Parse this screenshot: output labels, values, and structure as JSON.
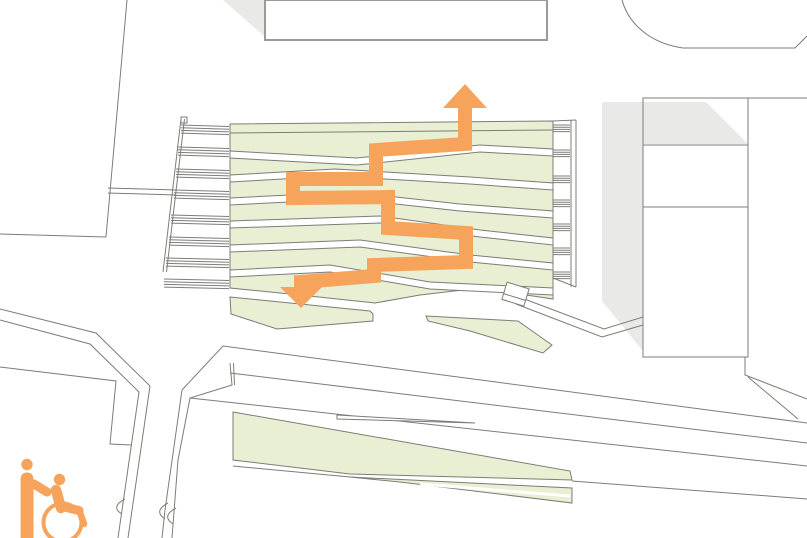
{
  "meta": {
    "kind": "architectural-site-plan",
    "description": "Accessibility route diagram over terraced landscape plan"
  },
  "colors": {
    "orange": "#F6A45C",
    "green": "#E9EFD2",
    "shadow": "#E9E9E7",
    "line": "#7C7C78",
    "buildingStroke": "#9A9A96",
    "white": "#ffffff"
  },
  "icons": {
    "legend": "wheelchair-with-attendant-icon",
    "route_up": "route-arrow-up-icon",
    "route_down": "route-arrow-down-icon"
  },
  "plan": {
    "width": 807,
    "height": 538,
    "shapes": [
      {
        "n": "building-right-fill",
        "t": "rect",
        "x": 643,
        "y": 98,
        "w": 105,
        "h": 259,
        "fill": "$white",
        "stroke": "none"
      },
      {
        "n": "shadow-top-left",
        "t": "polygon",
        "p": "223,0 265,0 265,37",
        "fill": "$shadow",
        "stroke": "none"
      },
      {
        "n": "shadow-right-building",
        "t": "polygon",
        "p": "602,102 706,102 748,144 643,144 643,351 602,301",
        "fill": "$shadow",
        "stroke": "none"
      },
      {
        "n": "building-top-center",
        "t": "rect",
        "x": 265,
        "y": 0,
        "w": 282,
        "h": 40,
        "fill": "$white",
        "stroke": "$buildingStroke",
        "sw": 2
      },
      {
        "n": "building-top-right-outline",
        "t": "path",
        "d": "M622,0 C628,22 648,43 683,48 L795,48 L807,36"
      },
      {
        "n": "building-right-outline",
        "t": "rect",
        "x": 643,
        "y": 98,
        "w": 105,
        "h": 259
      },
      {
        "n": "building-right-floor-line-1",
        "t": "line",
        "x1": 643,
        "y1": 145,
        "x2": 748,
        "y2": 145
      },
      {
        "n": "building-right-floor-line-2",
        "t": "line",
        "x1": 643,
        "y1": 207,
        "x2": 748,
        "y2": 207
      },
      {
        "n": "building-right-top-edge-ext",
        "t": "line",
        "x1": 748,
        "y1": 98,
        "x2": 807,
        "y2": 98
      },
      {
        "n": "plaza-boundary-diagonal",
        "t": "line",
        "x1": 127,
        "y1": 0,
        "x2": 106,
        "y2": 237
      },
      {
        "n": "plaza-boundary-bottom",
        "t": "line",
        "x1": 0,
        "y1": 234,
        "x2": 106,
        "y2": 237
      },
      {
        "n": "walkway-line-1",
        "t": "line",
        "x1": 108,
        "y1": 188,
        "x2": 176,
        "y2": 190
      },
      {
        "n": "walkway-line-2",
        "t": "line",
        "x1": 108,
        "y1": 193,
        "x2": 176,
        "y2": 195
      },
      {
        "n": "stairs-left-wall-outer",
        "t": "line",
        "x1": 181,
        "y1": 119,
        "x2": 163,
        "y2": 272
      },
      {
        "n": "stairs-left-wall-inner",
        "t": "line",
        "x1": 184.5,
        "y1": 119,
        "x2": 166.5,
        "y2": 272
      },
      {
        "n": "stairs-left-wall-cap",
        "t": "rect",
        "x": 181,
        "y": 117,
        "w": 6,
        "h": 6
      },
      {
        "n": "stairs-left-steps-1",
        "t": "hatch",
        "y": 125,
        "x1": 181,
        "x2": 229,
        "c": 4,
        "gap": 2.7,
        "dy": 1.5
      },
      {
        "n": "stairs-left-steps-2",
        "t": "hatch",
        "y": 147,
        "x1": 178,
        "x2": 229,
        "c": 4,
        "gap": 2.7,
        "dy": 1.5
      },
      {
        "n": "stairs-left-steps-3",
        "t": "hatch",
        "y": 169,
        "x1": 176,
        "x2": 229,
        "c": 4,
        "gap": 2.7,
        "dy": 1.5
      },
      {
        "n": "stairs-left-steps-4",
        "t": "hatch",
        "y": 190,
        "x1": 174,
        "x2": 229,
        "c": 4,
        "gap": 2.7,
        "dy": 1.5
      },
      {
        "n": "stairs-left-steps-5",
        "t": "hatch",
        "y": 215,
        "x1": 171,
        "x2": 229,
        "c": 4,
        "gap": 2.7,
        "dy": 1.5
      },
      {
        "n": "stairs-left-steps-6",
        "t": "hatch",
        "y": 237,
        "x1": 169,
        "x2": 229,
        "c": 4,
        "gap": 2.7,
        "dy": 1.5
      },
      {
        "n": "stairs-left-steps-7",
        "t": "hatch",
        "y": 258,
        "x1": 166,
        "x2": 229,
        "c": 4,
        "gap": 2.7,
        "dy": 1.5
      },
      {
        "n": "stairs-left-steps-8",
        "t": "hatch",
        "y": 279,
        "x1": 164,
        "x2": 229,
        "c": 4,
        "gap": 2.7,
        "dy": 1.5
      },
      {
        "n": "stairs-right-edge-1",
        "t": "line",
        "x1": 571,
        "y1": 120,
        "x2": 571,
        "y2": 287
      },
      {
        "n": "stairs-right-edge-2",
        "t": "line",
        "x1": 576,
        "y1": 120,
        "x2": 576,
        "y2": 287
      },
      {
        "n": "stairs-right-cap",
        "t": "line",
        "x1": 553,
        "y1": 121,
        "x2": 576,
        "y2": 120
      },
      {
        "n": "stairs-right-bottom",
        "t": "line",
        "x1": 553,
        "y1": 278,
        "x2": 576,
        "y2": 287
      },
      {
        "n": "stairs-right-steps-1",
        "t": "hatch",
        "y": 125,
        "x1": 553,
        "x2": 570,
        "c": 4,
        "gap": 2.2,
        "dy": 0
      },
      {
        "n": "stairs-right-steps-2",
        "t": "hatch",
        "y": 150,
        "x1": 553,
        "x2": 570,
        "c": 4,
        "gap": 2.2,
        "dy": 0
      },
      {
        "n": "stairs-right-steps-3",
        "t": "hatch",
        "y": 176,
        "x1": 553,
        "x2": 570,
        "c": 4,
        "gap": 2.2,
        "dy": 0
      },
      {
        "n": "stairs-right-steps-4",
        "t": "hatch",
        "y": 200,
        "x1": 553,
        "x2": 570,
        "c": 4,
        "gap": 2.2,
        "dy": 0
      },
      {
        "n": "stairs-right-steps-5",
        "t": "hatch",
        "y": 224,
        "x1": 553,
        "x2": 570,
        "c": 4,
        "gap": 2.2,
        "dy": 0
      },
      {
        "n": "stairs-right-steps-6",
        "t": "hatch",
        "y": 248,
        "x1": 553,
        "x2": 570,
        "c": 4,
        "gap": 2.2,
        "dy": 0
      },
      {
        "n": "stairs-right-steps-7",
        "t": "hatch",
        "y": 272,
        "x1": 553,
        "x2": 570,
        "c": 4,
        "gap": 2.2,
        "dy": 0
      },
      {
        "n": "road-edge-main",
        "t": "polyline",
        "p": "807,423 223,346 182,390 165,510 162,538"
      },
      {
        "n": "road-bump-1",
        "t": "path",
        "d": "M168,503 Q153,511 165,519"
      },
      {
        "n": "road-edge-inner",
        "t": "polyline",
        "p": "230,363 232,385 190,398 178,460 172,538"
      },
      {
        "n": "road-bump-2",
        "t": "path",
        "d": "M176,508 Q161,516 173,524"
      },
      {
        "n": "road-divider-hook",
        "t": "line",
        "x1": 233.5,
        "y1": 363,
        "x2": 234.5,
        "y2": 385
      },
      {
        "n": "road-divider-upper",
        "t": "line",
        "x1": 230,
        "y1": 373,
        "x2": 807,
        "y2": 443
      },
      {
        "n": "road-edge-lower",
        "t": "line",
        "x1": 190,
        "y1": 398,
        "x2": 807,
        "y2": 466
      },
      {
        "n": "street-left-edge-outer",
        "t": "polyline",
        "p": "0,309 96,333 150,386 128,538"
      },
      {
        "n": "street-left-edge-inner",
        "t": "polyline",
        "p": "0,320 90,344 139,392 118,538"
      },
      {
        "n": "street-bump",
        "t": "path",
        "d": "M125,499 Q110,507 122,514"
      },
      {
        "n": "plaza-left-boundary",
        "t": "polyline",
        "p": "0,367 116,381 110,444 131,445"
      },
      {
        "n": "road-right-corner-1",
        "t": "polyline",
        "p": "745,357 745,375 807,399"
      },
      {
        "n": "road-right-corner-2",
        "t": "line",
        "x1": 748,
        "y1": 377,
        "x2": 798,
        "y2": 419
      },
      {
        "n": "footpath-line-1",
        "t": "polyline",
        "p": "519,297 604,329 643,317"
      },
      {
        "n": "footpath-line-2",
        "t": "polyline",
        "p": "516,304 602,337 643,325"
      },
      {
        "n": "roadside-line",
        "t": "line",
        "x1": 572,
        "y1": 481,
        "x2": 807,
        "y2": 499
      },
      {
        "n": "wedge-under-line",
        "t": "line",
        "x1": 233,
        "y1": 466,
        "x2": 350,
        "y2": 477
      },
      {
        "n": "terrace-field",
        "t": "polygon",
        "p": "230,124 553,121 553,299 480,288 420,295 375,303 300,295 230,288",
        "fill": "$green"
      },
      {
        "n": "terrace-top-band-line",
        "t": "line",
        "x1": 230,
        "y1": 133,
        "x2": 553,
        "y2": 130
      },
      {
        "n": "terrace-ramp-band-1",
        "t": "band",
        "top": [
          [
            230,
            151
          ],
          [
            357,
            158
          ],
          [
            480,
            145
          ],
          [
            553,
            149
          ]
        ],
        "th": 7,
        "fill": "$white"
      },
      {
        "n": "terrace-ramp-band-2",
        "t": "band",
        "top": [
          [
            230,
            175
          ],
          [
            335,
            169
          ],
          [
            470,
            177
          ],
          [
            553,
            183
          ]
        ],
        "th": 7,
        "fill": "$white"
      },
      {
        "n": "terrace-ramp-band-3",
        "t": "band",
        "top": [
          [
            230,
            198
          ],
          [
            350,
            192
          ],
          [
            460,
            204
          ],
          [
            553,
            211
          ]
        ],
        "th": 7,
        "fill": "$white"
      },
      {
        "n": "terrace-ramp-band-4",
        "t": "band",
        "top": [
          [
            230,
            221
          ],
          [
            380,
            216
          ],
          [
            480,
            230
          ],
          [
            553,
            238
          ]
        ],
        "th": 7,
        "fill": "$white"
      },
      {
        "n": "terrace-ramp-band-5",
        "t": "band",
        "top": [
          [
            230,
            245
          ],
          [
            360,
            240
          ],
          [
            470,
            255
          ],
          [
            553,
            263
          ]
        ],
        "th": 7,
        "fill": "$white"
      },
      {
        "n": "terrace-ramp-band-6",
        "t": "band",
        "top": [
          [
            230,
            270
          ],
          [
            330,
            265
          ],
          [
            430,
            282
          ],
          [
            553,
            288
          ]
        ],
        "th": 7,
        "fill": "$white"
      },
      {
        "n": "lawn-small-left",
        "t": "polygon",
        "p": "230,297 370,311 373,314 373,321 277,329 231,314",
        "fill": "$green"
      },
      {
        "n": "lawn-small-right",
        "t": "polygon",
        "p": "426,316 518,321 552,345 543,353 470,331 428,321",
        "fill": "$green"
      },
      {
        "n": "lawn-wedge-main",
        "t": "polygon",
        "p": "233,412 570,471 572,480 350,474 233,460",
        "fill": "$green"
      },
      {
        "n": "lawn-sliver",
        "t": "polygon",
        "p": "350,477 572,488 572,503 400,482",
        "fill": "$green"
      },
      {
        "n": "lawn-sliver-split",
        "t": "line",
        "x1": 420,
        "y1": 484,
        "x2": 570,
        "y2": 496,
        "stroke": "$white",
        "sw": 3
      },
      {
        "n": "lane-needle",
        "t": "polygon",
        "p": "337,415 475,423 337,419",
        "fill": "$white"
      },
      {
        "n": "accessible-route-path",
        "t": "polyline",
        "p": "465,104 465,144 376,150 376,179 293,179 293,198 388,197 388,228 466,233 466,262 374,265 374,276 301,282 301,289",
        "stroke": "$orange",
        "sw": 14
      },
      {
        "n": "route-arrow-up-icon",
        "t": "polygon",
        "p": "443,108 487,108 465,84",
        "fill": "$orange",
        "stroke": "none"
      },
      {
        "n": "route-arrow-down-icon",
        "t": "polygon",
        "p": "280,287 322,287 301,308",
        "fill": "$orange",
        "stroke": "none"
      },
      {
        "n": "kiosk-structure",
        "t": "rect",
        "x": 504,
        "y": 285,
        "w": 23,
        "h": 18,
        "fill": "$white",
        "tf": "rotate(17 515 294)"
      },
      {
        "n": "kiosk-inner-line",
        "t": "line",
        "x1": 504,
        "y1": 297,
        "x2": 527,
        "y2": 297,
        "tf": "rotate(17 515 294)"
      },
      {
        "n": "attendant-head",
        "t": "circle",
        "cx": 27,
        "cy": 464.5,
        "r": 5.7,
        "fill": "$orange",
        "stroke": "none"
      },
      {
        "n": "attendant-body",
        "t": "path",
        "d": "M20.5,480 Q20.5,472.5 27,472.5 Q33.5,472.5 33.5,480 L33.5,538 L20.5,538 Z",
        "fill": "$orange",
        "stroke": "none"
      },
      {
        "n": "attendant-arm",
        "t": "line",
        "x1": 34,
        "y1": 484,
        "x2": 47,
        "y2": 492,
        "stroke": "$orange",
        "sw": 9,
        "cap": "round"
      },
      {
        "n": "wheelchair-user-head",
        "t": "circle",
        "cx": 59.5,
        "cy": 479.5,
        "r": 5.7,
        "fill": "$orange",
        "stroke": "none"
      },
      {
        "n": "wheelchair-user-torso",
        "t": "line",
        "x1": 56,
        "y1": 490,
        "x2": 61,
        "y2": 508,
        "stroke": "$orange",
        "sw": 10.5,
        "cap": "round"
      },
      {
        "n": "wheelchair-user-thigh",
        "t": "line",
        "x1": 60,
        "y1": 506,
        "x2": 79,
        "y2": 510.5,
        "stroke": "$orange",
        "sw": 9,
        "cap": "round"
      },
      {
        "n": "wheelchair-user-leg",
        "t": "line",
        "x1": 79.5,
        "y1": 511,
        "x2": 84,
        "y2": 524,
        "stroke": "$orange",
        "sw": 6.5,
        "cap": "round"
      },
      {
        "n": "wheelchair-wheel",
        "t": "circle",
        "cx": 62.5,
        "cy": 522.5,
        "r": 19,
        "fill": "none",
        "stroke": "$orange",
        "sw": 4
      }
    ]
  }
}
